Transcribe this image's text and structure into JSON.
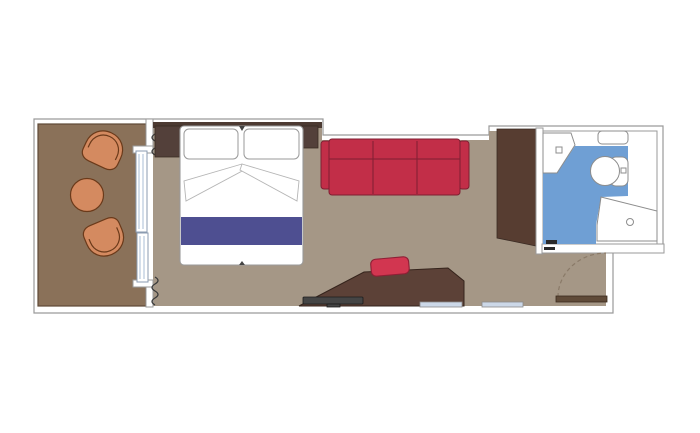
{
  "diagram": {
    "type": "cruise-cabin-floor-plan",
    "rooms": [
      {
        "name": "balcony",
        "furniture": [
          "deck-chair-top",
          "round-table",
          "deck-chair-bottom",
          "sliding-glass-door",
          "curtains"
        ]
      },
      {
        "name": "cabin",
        "furniture": [
          "double-bed",
          "pillow-left",
          "pillow-right",
          "blanket-runner",
          "nightstand-left",
          "nightstand-right",
          "sofa",
          "wardrobe",
          "desk",
          "stool",
          "tv",
          "mirror-strip-left",
          "mirror-strip-right"
        ]
      },
      {
        "name": "bathroom",
        "furniture": [
          "sink",
          "shelf",
          "toilet",
          "shower"
        ]
      },
      {
        "name": "entry",
        "furniture": [
          "entrance-door",
          "door-swing-arc",
          "bathroom-door-stops"
        ]
      }
    ]
  },
  "colors": {
    "background": "#ffffff",
    "wall_fill": "#ffffff",
    "wall_stroke": "#9a9a9a",
    "balcony_floor": "#8a7159",
    "balcony_floor_stroke": "#5f4936",
    "cabin_floor": "#a59786",
    "bathroom_floor": "#6f9fd4",
    "bathroom_room": "#ffffff",
    "fixture_fill": "#ffffff",
    "fixture_stroke": "#8d8d8d",
    "headboard_wall": "#4c3a32",
    "nightstand": "#53403a",
    "nightstand_stroke": "#3a2b24",
    "wardrobe": "#573d31",
    "desk": "#5c4137",
    "desk_stroke": "#35241c",
    "entry_door": "#5f4a38",
    "entry_door_stroke": "#3a2a1d",
    "door_arc": "#8a7a68",
    "door_stop": "#2a2a2a",
    "sofa": "#c22e48",
    "sofa_stroke": "#7f1f32",
    "stool": "#d23650",
    "stool_stroke": "#8e1f35",
    "bed_fill": "#ffffff",
    "bed_stroke": "#9a9a9a",
    "bed_fold_stroke": "#b5b5b5",
    "bed_notch": "#444444",
    "blanket": "#4e4f91",
    "chair": "#d48a60",
    "chair_stroke": "#6b3a1a",
    "table": "#d48a60",
    "tv": "#454545",
    "tv_stroke": "#1c1c1c",
    "window_strip": "#ccd8e8",
    "window_strip_stroke": "#8a8a8a",
    "curtain": "#3a3a3a",
    "door_glass": "#a8bcd6",
    "door_frame_stroke": "#8b9bb0"
  }
}
